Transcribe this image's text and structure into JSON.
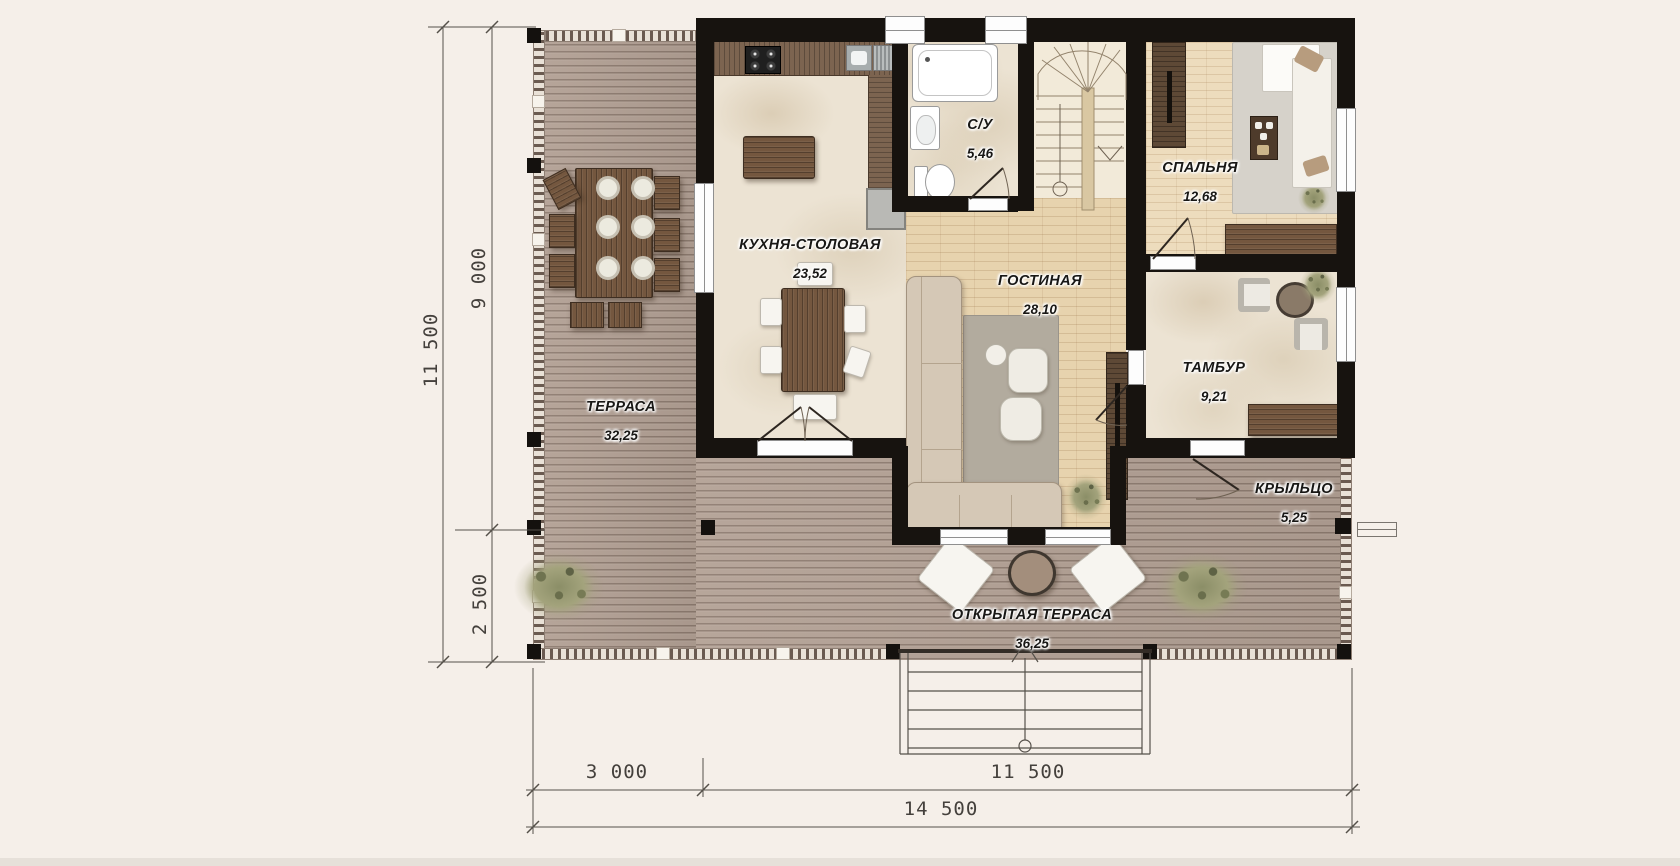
{
  "plan": {
    "rooms": [
      {
        "id": "terrace",
        "name": "ТЕРРАСА",
        "area": "32,25"
      },
      {
        "id": "kitchen",
        "name": "КУХНЯ-СТОЛОВАЯ",
        "area": "23,52"
      },
      {
        "id": "bathroom",
        "name": "С/У",
        "area": "5,46"
      },
      {
        "id": "living",
        "name": "ГОСТИНАЯ",
        "area": "28,10"
      },
      {
        "id": "bedroom",
        "name": "СПАЛЬНЯ",
        "area": "12,68"
      },
      {
        "id": "vestibule",
        "name": "ТАМБУР",
        "area": "9,21"
      },
      {
        "id": "porch",
        "name": "КРЫЛЬЦО",
        "area": "5,25"
      },
      {
        "id": "open-terrace",
        "name": "ОТКРЫТАЯ ТЕРРАСА",
        "area": "36,25"
      }
    ],
    "dimensions": {
      "left_outer": "11 500",
      "left_upper": "9 000",
      "left_lower": "2 500",
      "bottom_left": "3 000",
      "bottom_right": "11 500",
      "bottom_total": "14 500"
    },
    "colors": {
      "background": "#f5efe9",
      "wall": "#17130f",
      "deck": "#b3a195",
      "marble_floor": "#ece3d3",
      "wood_floor": "#e7d3ae",
      "furniture_wood": "#74573f"
    }
  }
}
